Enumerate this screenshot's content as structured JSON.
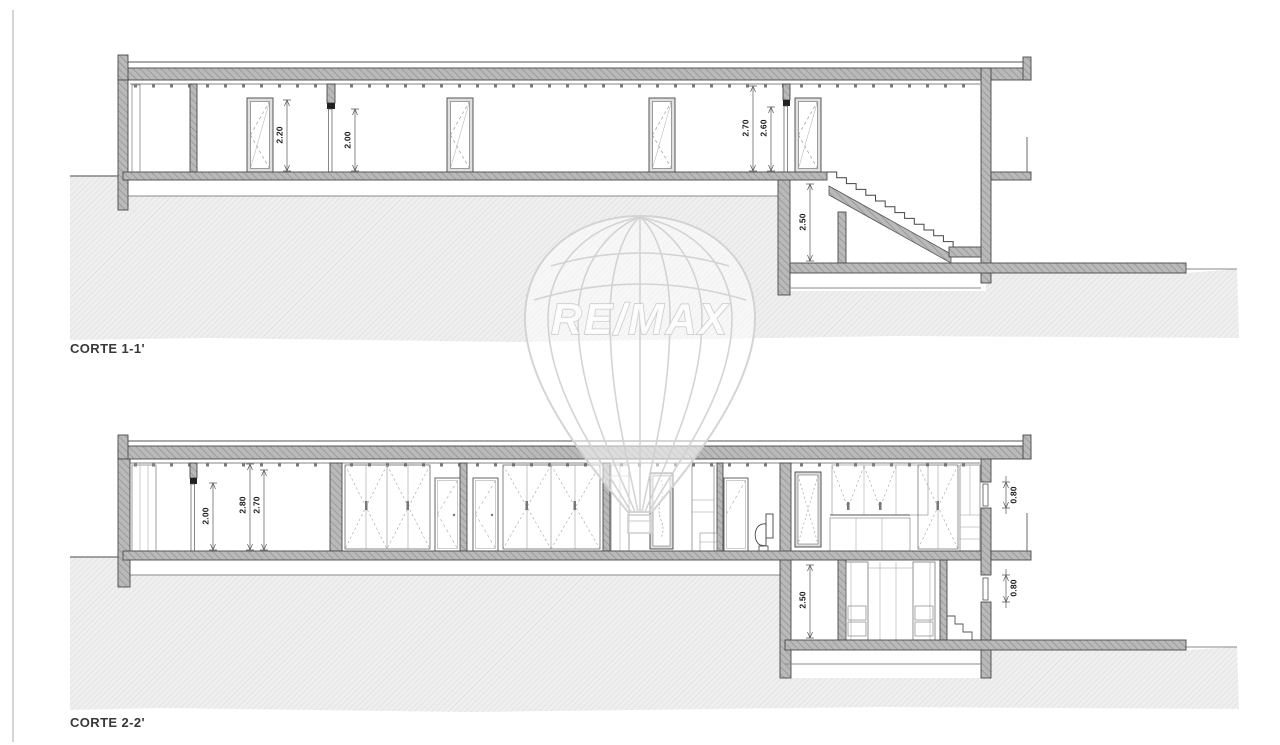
{
  "drawing": {
    "watermark_brand": "RE/MAX",
    "sections": [
      {
        "label": "CORTE 1-1'",
        "dims": {
          "door_height": "2.20",
          "opening_height": "2.00",
          "ceiling_height": "2.70",
          "door2_height": "2.60",
          "basement_height": "2.50"
        }
      },
      {
        "label": "CORTE 2-2'",
        "dims": {
          "opening_height": "2.00",
          "slab_height": "2.80",
          "ceiling_height": "2.70",
          "window_upper": "0.80",
          "basement_height": "2.50",
          "window_lower": "0.80"
        }
      }
    ]
  },
  "colors": {
    "wall_fill": "#b9b9b9",
    "wall_hatch": "#8e8e8e",
    "ground_fill": "#efefef",
    "ground_hatch": "#d8d8d8",
    "line": "#4a4a4a",
    "watermark": "#d2d2d2",
    "label_text": "#383838"
  }
}
